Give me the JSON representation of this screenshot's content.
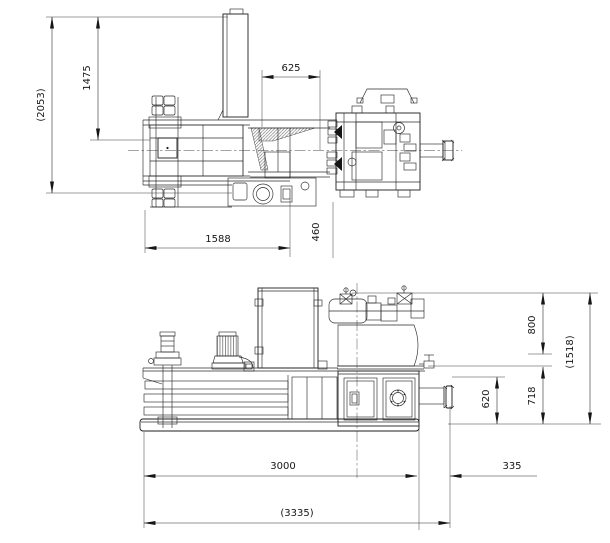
{
  "drawing": {
    "type": "technical-cad-drawing",
    "subject": "horizontal baling press - dimensioned general arrangement, plan view and side elevation",
    "units": "mm",
    "line_color": "#1d1d1d",
    "background": "#ffffff",
    "top_view": {
      "dims": {
        "overall_depth": "(2053)",
        "body_depth": "1475",
        "hopper_to_press": "625",
        "chamber_length": "1588",
        "outlet_offset": "460"
      }
    },
    "side_view": {
      "dims": {
        "power_pack_height": "800",
        "overall_height": "(1518)",
        "frame_height": "718",
        "discharge_height": "620",
        "body_length": "3000",
        "discharge_extension": "335",
        "overall_length": "(3335)"
      }
    }
  }
}
